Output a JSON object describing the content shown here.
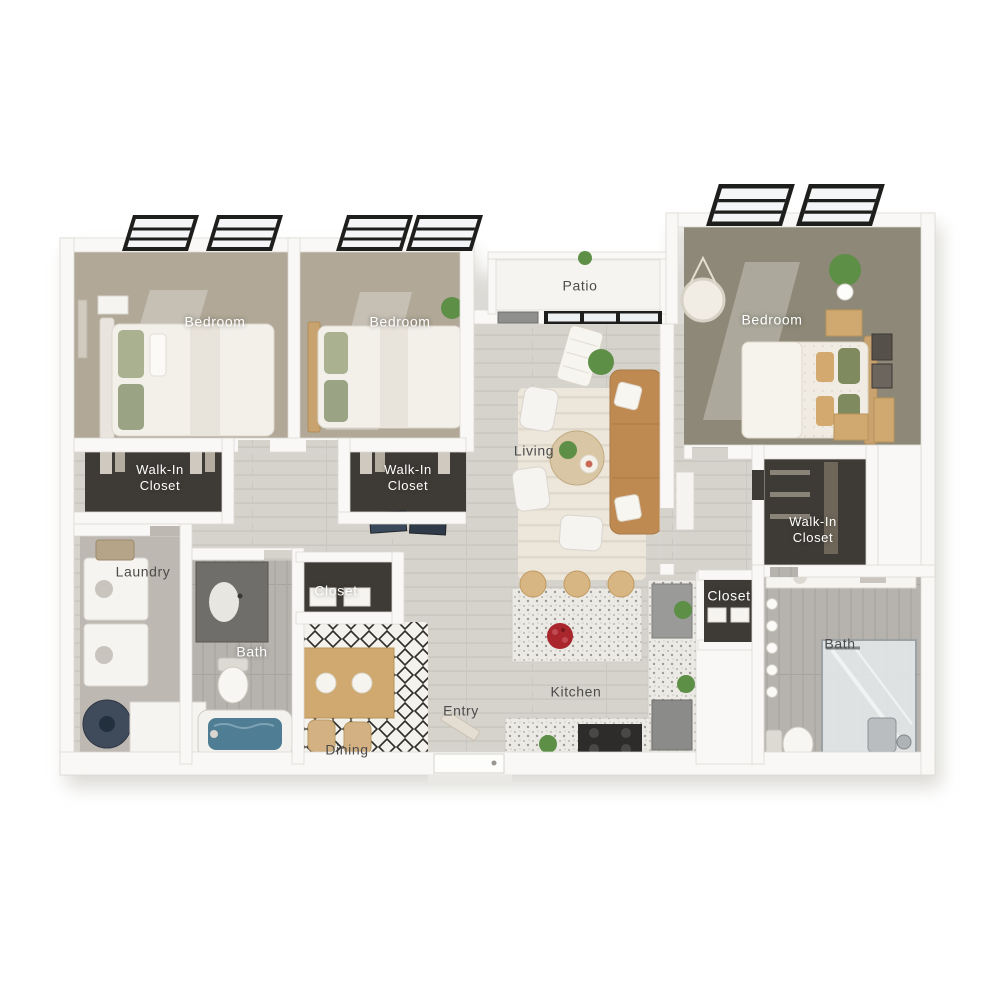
{
  "plan": {
    "title": "3-bedroom, 2-bath apartment 3D floor plan",
    "labels": {
      "patio": "Patio",
      "bedroom_left": "Bedroom",
      "bedroom_middle": "Bedroom",
      "bedroom_right": "Bedroom",
      "walk_in_closet_left": "Walk-In Closet",
      "walk_in_closet_middle": "Walk-In Closet",
      "walk_in_closet_right": "Walk-In Closet",
      "living": "Living",
      "laundry": "Laundry",
      "closet_middle": "Closet",
      "closet_right": "Closet",
      "bath_left": "Bath",
      "bath_right": "Bath",
      "dining": "Dining",
      "entry": "Entry",
      "kitchen": "Kitchen"
    },
    "colors": {
      "background": "#ffffff",
      "wall": "#f9f8f6",
      "wood_floor": "#d6d3cd",
      "carpet_light": "#b1a897",
      "carpet_dark": "#8d8877",
      "bath_tile": "#b6b3ae",
      "closet_interior": "#3e3b37",
      "window_frame": "#1e1e1c",
      "sofa_tan": "#bf8a52",
      "accent_red": "#a8262c",
      "plant_green": "#5d8f46",
      "tub_water": "#4f7d94",
      "label_dark": "#4c4c4c",
      "label_light": "#ffffff"
    }
  }
}
